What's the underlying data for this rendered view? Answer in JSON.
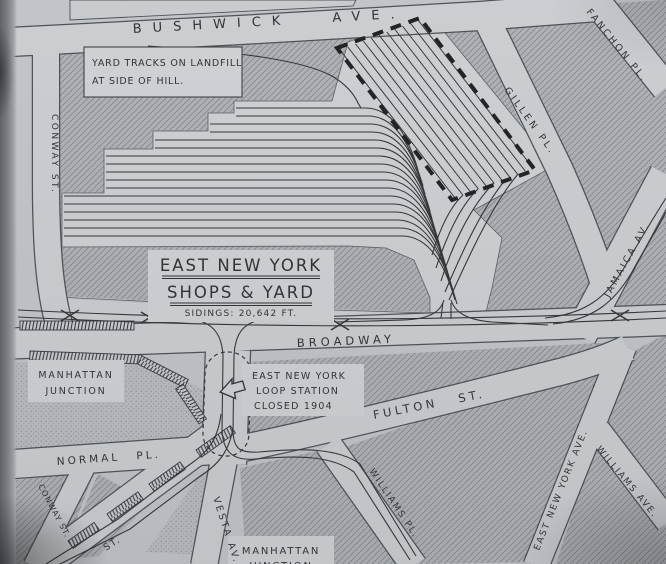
{
  "map": {
    "streets": {
      "bushwick": "BUSHWICK AVE.",
      "fanchon": "FANCHON PL.",
      "gillen": "GILLEN PL.",
      "conway_upper": "CONWAY ST.",
      "jamaica": "JAMAICA AV.",
      "broadway": "BROADWAY",
      "fulton": "FULTON ST.",
      "normal": "NORMAL PL.",
      "conway_lower": "CONWAY ST.",
      "st_fragment": "ST.",
      "vesta": "VESTA AV.",
      "williams_pl": "WILLIAMS PL.",
      "east_new_york_ave": "EAST NEW YORK AVE.",
      "williams_ave": "WILLIAMS AVE."
    },
    "notes": {
      "yard_note": {
        "line1": "YARD TRACKS ON LANDFILL",
        "line2": "AT SIDE OF HILL."
      },
      "yard_title": {
        "line1": "EAST NEW YORK",
        "line2": "SHOPS & YARD",
        "line3": "SIDINGS: 20,642 FT."
      },
      "manhattan_junction_upper": {
        "line1": "MANHATTAN",
        "line2": "JUNCTION"
      },
      "loop_station": {
        "line1": "EAST NEW YORK",
        "line2": "LOOP STATION",
        "line3": "CLOSED 1904"
      },
      "manhattan_junction_lower": {
        "line1": "MANHATTAN",
        "line2": "JUNCTION"
      }
    },
    "colors": {
      "paper": "#c6cace",
      "street": "#d0d4d7",
      "block": "#b3b7ba",
      "ink": "#2b2e30",
      "building_outline": "#1a1c1e"
    }
  }
}
